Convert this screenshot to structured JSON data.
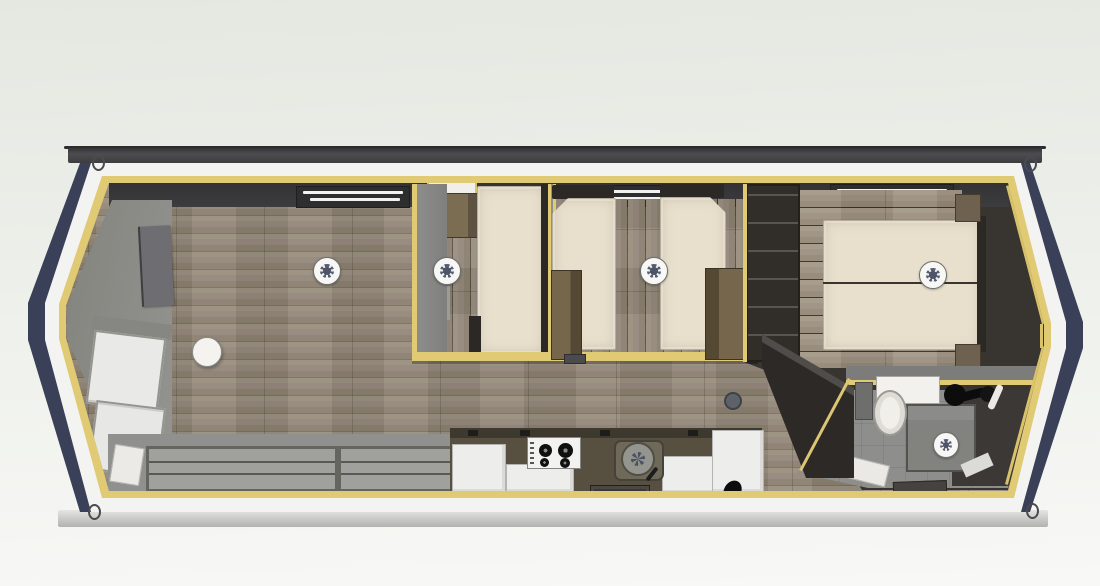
{
  "meta": {
    "type": "3d-floorplan-render",
    "subject": "Top-down cutaway render of a holiday lodge / static caravan",
    "view": "plan view from above",
    "visible_text": "none"
  },
  "palette": {
    "background_top": "#e5e8e1",
    "background_bottom": "#f8f8f6",
    "roof_edge": "#424246",
    "fascia_band": "#f3f3f1",
    "timber_trim": "#e0ca74",
    "end_cladding_navy": "#394058",
    "wall_dark_charcoal": "#39393b",
    "wall_grey": "#8f8f8d",
    "floor_wood": "#95897a",
    "floor_bathroom_grey": "#8e8e8c",
    "mattress_cream": "#e8e0cd",
    "wardrobe_wood": "#75664c",
    "kitchen_worktop": "#574f40",
    "cabinet_white": "#ededeb"
  },
  "structure": {
    "shape": "elongated unit with angled bay ends",
    "roof_edge_bar": "flat roof fascia along top",
    "base_rail": "chassis base rail along bottom",
    "lifting_rings": 4,
    "trim": "yellow timber trim ringing walls and partitions"
  },
  "rooms": {
    "living_room": {
      "label": "Living room",
      "features": [
        "wall-mounted TV",
        "round side table",
        "corner sofa / window seats",
        "sliding patio doors",
        "roof window",
        "ceiling light"
      ]
    },
    "kitchen": {
      "label": "Kitchen",
      "features": [
        "dark worktop run",
        "gas hob with 4 burners",
        "round sink with tap",
        "white base cabinets",
        "black kettle"
      ]
    },
    "bedroom_double": {
      "label": "Double bedroom",
      "features": [
        "double bed",
        "overhead locker",
        "wardrobe",
        "roof light",
        "ceiling light"
      ]
    },
    "bedroom_twin": {
      "label": "Twin bedroom",
      "features": [
        "single bed left",
        "single bed right",
        "foot-of-bed wardrobe left",
        "foot-of-bed wardrobe right",
        "ceiling light"
      ]
    },
    "bedroom_master": {
      "label": "Master bedroom",
      "features": [
        "double bed with split mattress",
        "two bedside cabinets",
        "open shelving unit",
        "ceiling light"
      ]
    },
    "bathroom": {
      "label": "Bathroom",
      "features": [
        "toilet",
        "vanity wash basin",
        "shower enclosure",
        "shower head",
        "bath mat",
        "ceiling light"
      ]
    },
    "hallway": {
      "label": "Hallway",
      "features": [
        "angled tall cabinet",
        "floor vent",
        "entrance mat"
      ]
    }
  },
  "fixtures": {
    "ceiling_lights": 5,
    "roof_windows": 4
  }
}
